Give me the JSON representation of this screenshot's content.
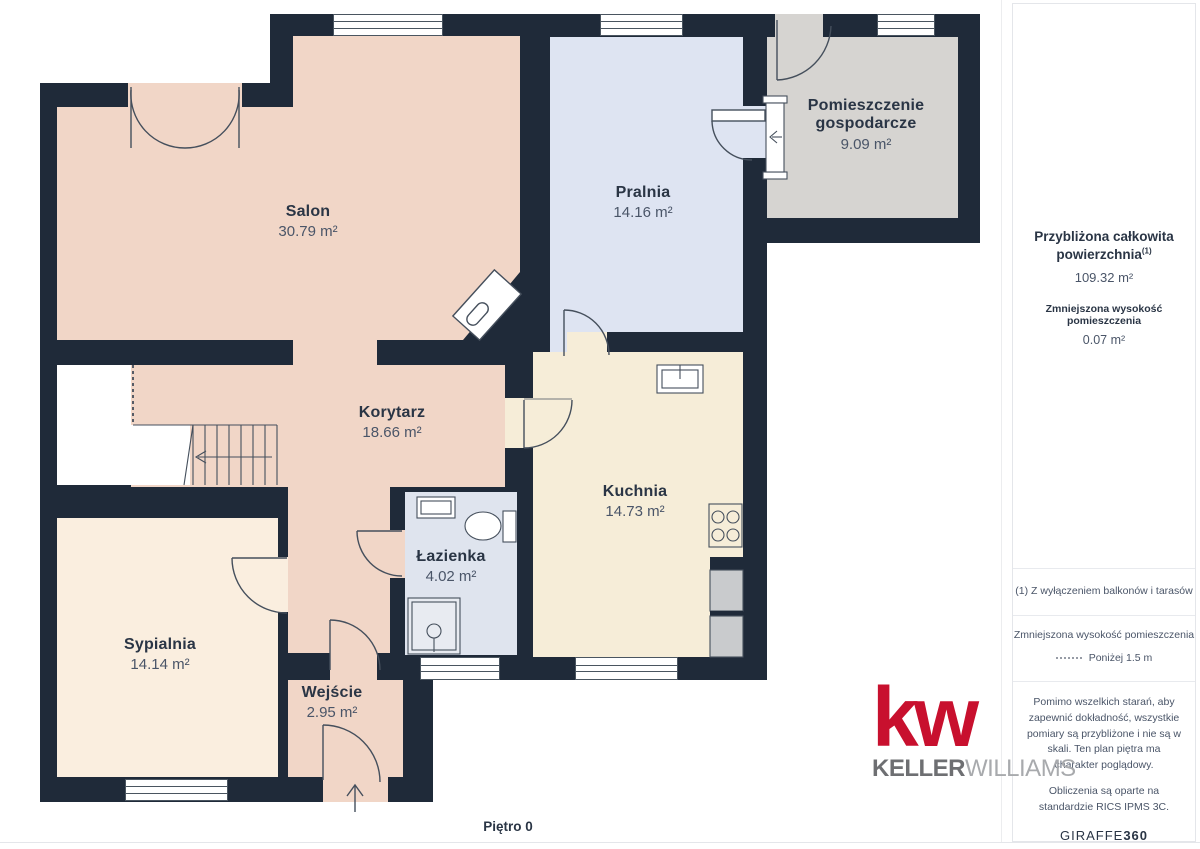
{
  "floor_label": "Piętro 0",
  "rooms": {
    "salon": {
      "name": "Salon",
      "area": "30.79 m²",
      "fill": "#F1D6C7"
    },
    "pralnia": {
      "name": "Pralnia",
      "area": "14.16 m²",
      "fill": "#DEE4F2"
    },
    "gospodarcze": {
      "name": "Pomieszczenie gospodarcze",
      "area": "9.09 m²",
      "fill": "#D6D4D1"
    },
    "korytarz": {
      "name": "Korytarz",
      "area": "18.66 m²",
      "fill": "#F1D6C7"
    },
    "kuchnia": {
      "name": "Kuchnia",
      "area": "14.73 m²",
      "fill": "#F6EDD8"
    },
    "lazienka": {
      "name": "Łazienka",
      "area": "4.02 m²",
      "fill": "#DFE4EE"
    },
    "sypialnia": {
      "name": "Sypialnia",
      "area": "14.14 m²",
      "fill": "#FAEEDF"
    },
    "wejscie": {
      "name": "Wejście",
      "area": "2.95 m²",
      "fill": "#F1D6C7"
    }
  },
  "sidebar": {
    "total_area_label": "Przybliżona całkowita powierzchnia",
    "total_area_footnote_mark": "(1)",
    "total_area_value": "109.32 m²",
    "reduced_height_label": "Zmniejszona wysokość pomieszczenia",
    "reduced_height_value": "0.07 m²",
    "footnote": "(1) Z wyłączeniem balkonów i tarasów",
    "legend_label": "Zmniejszona wysokość pomieszczenia",
    "legend_value": "Poniżej 1.5 m",
    "disclaimer": "Pomimo wszelkich starań, aby zapewnić dokładność, wszystkie pomiary są przybliżone i nie są w skali. Ten plan piętra ma charakter poglądowy.",
    "standard_note": "Obliczenia są oparte na standardzie RICS IPMS 3C.",
    "brand_prefix": "GIRAFFE",
    "brand_suffix": "360"
  },
  "logo": {
    "mark": "kw",
    "name_bold": "KELLER",
    "name_light": "WILLIAMS"
  },
  "colors": {
    "wall": "#1F2A39",
    "brand_red": "#C8102E",
    "label_dark": "#2A3545",
    "label_gray": "#4A5568"
  }
}
